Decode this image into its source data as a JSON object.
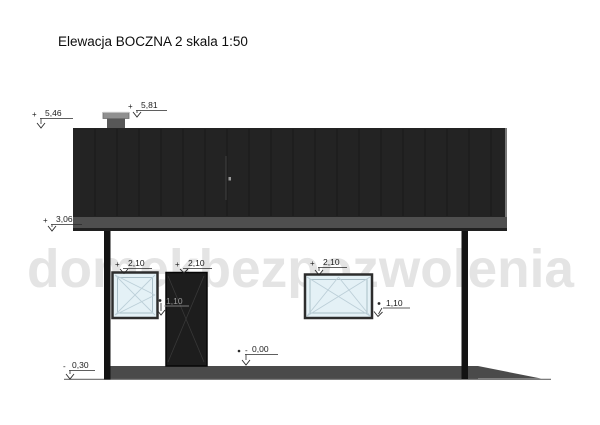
{
  "title": "Elewacja BOCZNA 2 skala 1:50",
  "watermark": "domekbezpozwolenia",
  "colors": {
    "roof": "#232323",
    "roof_seam": "#191919",
    "fascia": "#4f4f4f",
    "fascia_edge": "#202020",
    "chimney_body": "#575757",
    "chimney_cap": "#909090",
    "column": "#131313",
    "window_glass": "#e4f1f6",
    "window_frame": "#2d2d2d",
    "door": "#1d1d1d",
    "plinth": "#4a4a4a",
    "watermark": "#e4e4e4"
  },
  "markers": [
    {
      "id": "roof-ridge",
      "sign": "+",
      "value": "5,46"
    },
    {
      "id": "chimney-top",
      "sign": "+",
      "value": "5,81"
    },
    {
      "id": "eave",
      "sign": "+",
      "value": "3,06"
    },
    {
      "id": "left-window-top",
      "sign": "+",
      "value": "2,10"
    },
    {
      "id": "door-top",
      "sign": "+",
      "value": "2,10"
    },
    {
      "id": "right-window-top",
      "sign": "+",
      "value": "2,10"
    },
    {
      "id": "left-window-sill",
      "sign": "•",
      "value": "1,10"
    },
    {
      "id": "right-window-sill",
      "sign": "•",
      "value": "1,10"
    },
    {
      "id": "floor-level",
      "sign": "-",
      "value": "0,00"
    },
    {
      "id": "ground-level",
      "sign": "-",
      "value": "0,30"
    }
  ]
}
